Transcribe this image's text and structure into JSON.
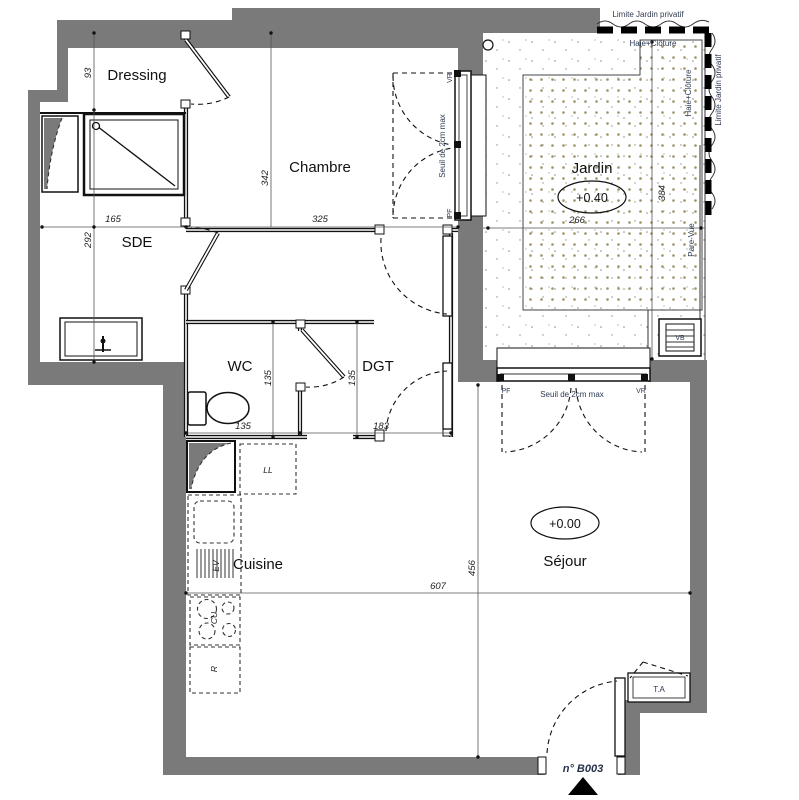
{
  "rooms": {
    "dressing": "Dressing",
    "chambre": "Chambre",
    "sde": "SDE",
    "wc": "WC",
    "dgt": "DGT",
    "cuisine": "Cuisine",
    "sejour": "Séjour",
    "jardin": "Jardin"
  },
  "levels": {
    "jardin": "+0.40",
    "sejour": "+0.00"
  },
  "dims": {
    "d93": "93",
    "d165": "165",
    "d292": "292",
    "d342": "342",
    "d325": "325",
    "d135_wc_w": "135",
    "d135_wc_h": "135",
    "d135_dgt": "135",
    "d183": "183",
    "d266": "266",
    "d384": "384",
    "d607": "607",
    "d456": "456"
  },
  "annotations": {
    "limite_top": "Limite Jardin privatif",
    "haie_top": "Haie+Clôture",
    "haie_right": "Haie+Clôture",
    "limite_right": "Limite Jardin privatif",
    "pare_vue": "Pare-Vue",
    "vb": "VB",
    "ta": "T.A",
    "pf_chambre": "PF",
    "vr_chambre": "VR",
    "pf_sejour": "PF",
    "vr_sejour": "VR",
    "seuil_chambre": "Seuil de 2cm max",
    "seuil_sejour": "Seuil de 2cm max",
    "unit": "n° B003"
  },
  "equipment": {
    "ll": "LL",
    "ev": "EV",
    "cu": "CU",
    "r": "R"
  }
}
